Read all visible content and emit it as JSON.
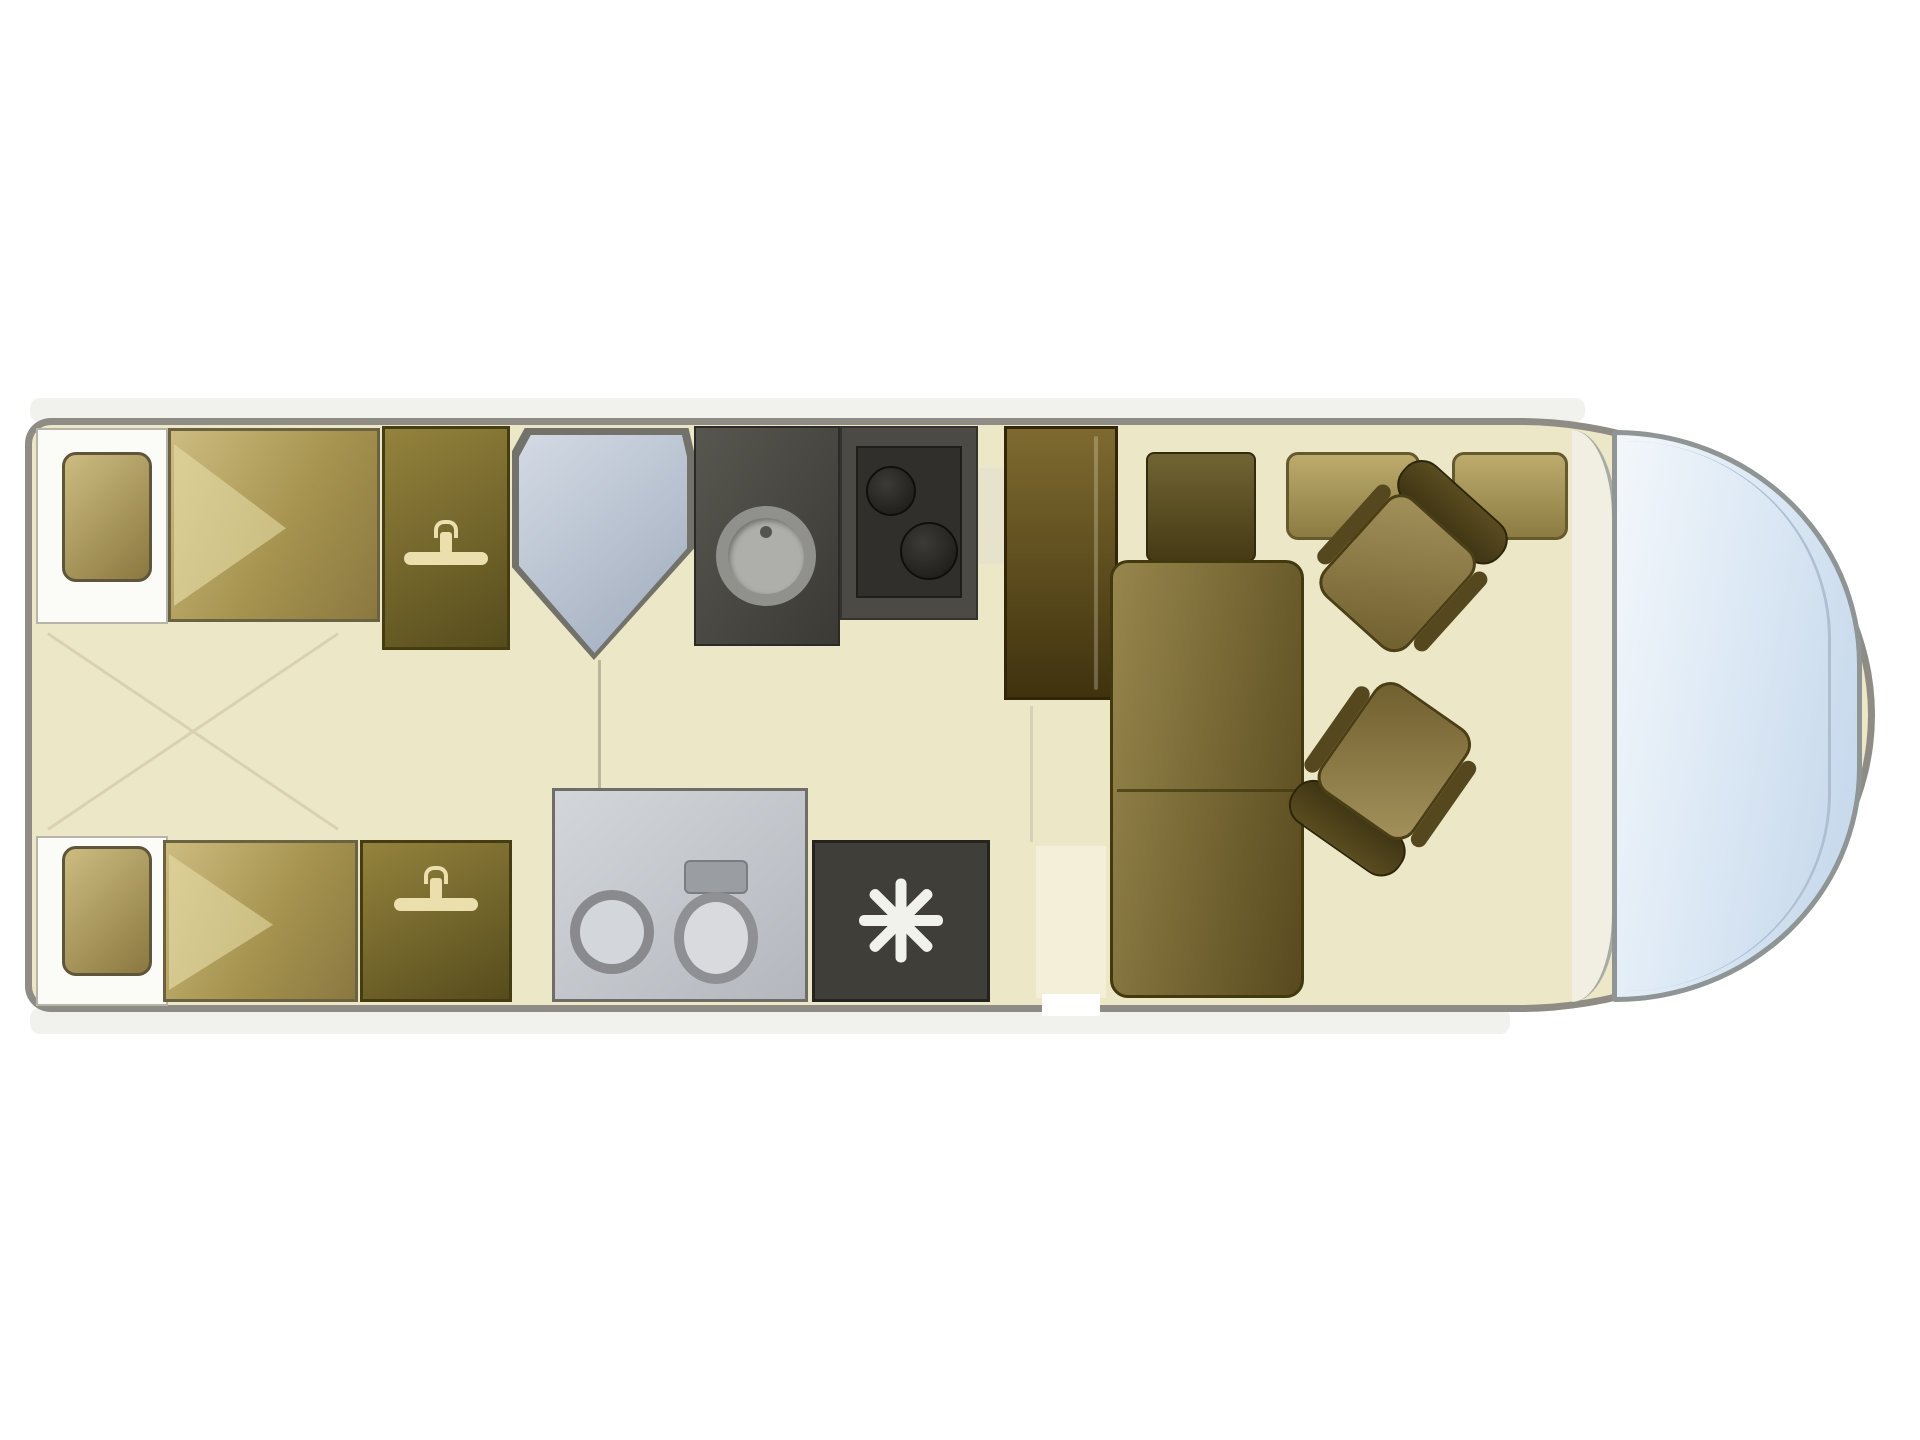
{
  "title": "Motorhome floor plan diagram",
  "colors": {
    "floor": "#ece7c6",
    "wall": "#8e8c84",
    "wall_light": "#fbfbf8",
    "skirt": "#f1f2ee",
    "bed_light": "#cdbc80",
    "bed_dark": "#8a7840",
    "pillow": "#dbcf97",
    "wardrobe_light": "#94833d",
    "wardrobe_dark": "#564c1c",
    "hanger": "#eadfad",
    "shower_frame": "#72726b",
    "shower_light": "#d3dae4",
    "shower_dark": "#9fabbd",
    "counter": "#57564f",
    "hob": "#4b4a44",
    "burner": "#171715",
    "sink_ring": "#90918d",
    "sink_fill": "#aeafab",
    "fridge_light": "#7e6a30",
    "fridge_dark": "#3f320e",
    "sofa_light": "#97864c",
    "sofa_dark": "#584a1e",
    "bench_light": "#bcab6c",
    "bench_dark": "#8d7c42",
    "seat_light": "#a4925c",
    "seat_dark": "#5a4c20",
    "bath_light": "#d3d6db",
    "bath_dark": "#b4b7bd",
    "fixture_ring": "#888a8e",
    "fixture_fill": "#d3d6da",
    "darksq": "#3f3e39",
    "star": "#f2f2ec",
    "windshield_light": "#f3f7fb",
    "windshield_mid": "#c2d5ea",
    "dash": "#f1efe1",
    "cross_line": "#d8d2b2"
  },
  "icons": {
    "hanger": "clothes-hanger-icon",
    "spray": "shower-spray-star-icon"
  },
  "elements": [
    "vehicle-body",
    "rear-locker-top",
    "rear-locker-bottom",
    "single-bed-top",
    "single-bed-bottom",
    "wardrobe-top",
    "wardrobe-bottom",
    "shower-cubicle",
    "washbasin-unit",
    "kitchen-hob",
    "fridge",
    "sideboard",
    "lounge-sofa",
    "dinette-bench-1",
    "dinette-bench-2",
    "cab-seat-passenger",
    "cab-seat-driver",
    "toilet-room",
    "toilet-sink",
    "toilet-bowl",
    "shower-tray-dark",
    "entrance-area",
    "dashboard",
    "windshield"
  ]
}
